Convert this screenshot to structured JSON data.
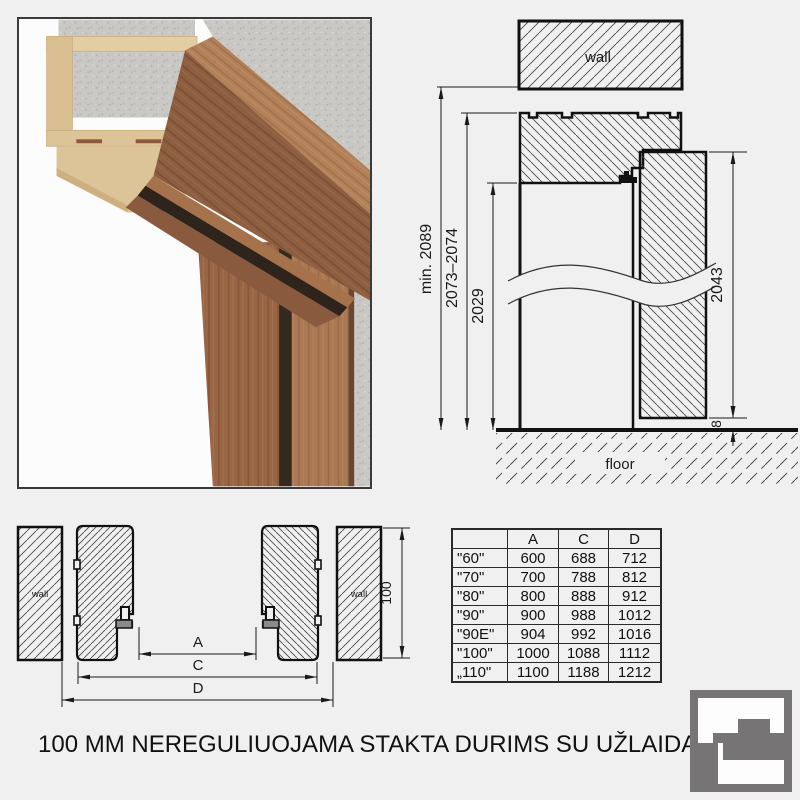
{
  "title": "100 MM NEREGULIUOJAMA STAKTA DURIMS SU UŽLAIDA",
  "colors": {
    "background": "#f0f0f0",
    "line": "#1a1a1a",
    "logo_grey": "#767474",
    "wood_front": "#8e5e41",
    "wood_top": "#b28159",
    "mdf": "#dcc498",
    "concrete": "#c9c8c4"
  },
  "section_diagram": {
    "wall_label": "wall",
    "floor_label": "floor",
    "dim_total": "min. 2089",
    "dim_frame": "2073–2074",
    "dim_opening": "2029",
    "dim_door": "2043",
    "dim_floor_gap": "8"
  },
  "plan_diagram": {
    "wall_left_label": "wall",
    "wall_right_label": "wall",
    "dim_a_label": "A",
    "dim_c_label": "C",
    "dim_d_label": "D",
    "dim_depth": "100"
  },
  "table": {
    "headers": [
      "",
      "A",
      "C",
      "D"
    ],
    "rows": [
      [
        "\"60\"",
        "600",
        "688",
        "712"
      ],
      [
        "\"70\"",
        "700",
        "788",
        "812"
      ],
      [
        "\"80\"",
        "800",
        "888",
        "912"
      ],
      [
        "\"90\"",
        "900",
        "988",
        "1012"
      ],
      [
        "\"90E\"",
        "904",
        "992",
        "1016"
      ],
      [
        "\"100\"",
        "1000",
        "1088",
        "1112"
      ],
      [
        "„110\"",
        "1100",
        "1188",
        "1212"
      ]
    ]
  },
  "logo": {
    "name": "frame-profile-logo"
  }
}
